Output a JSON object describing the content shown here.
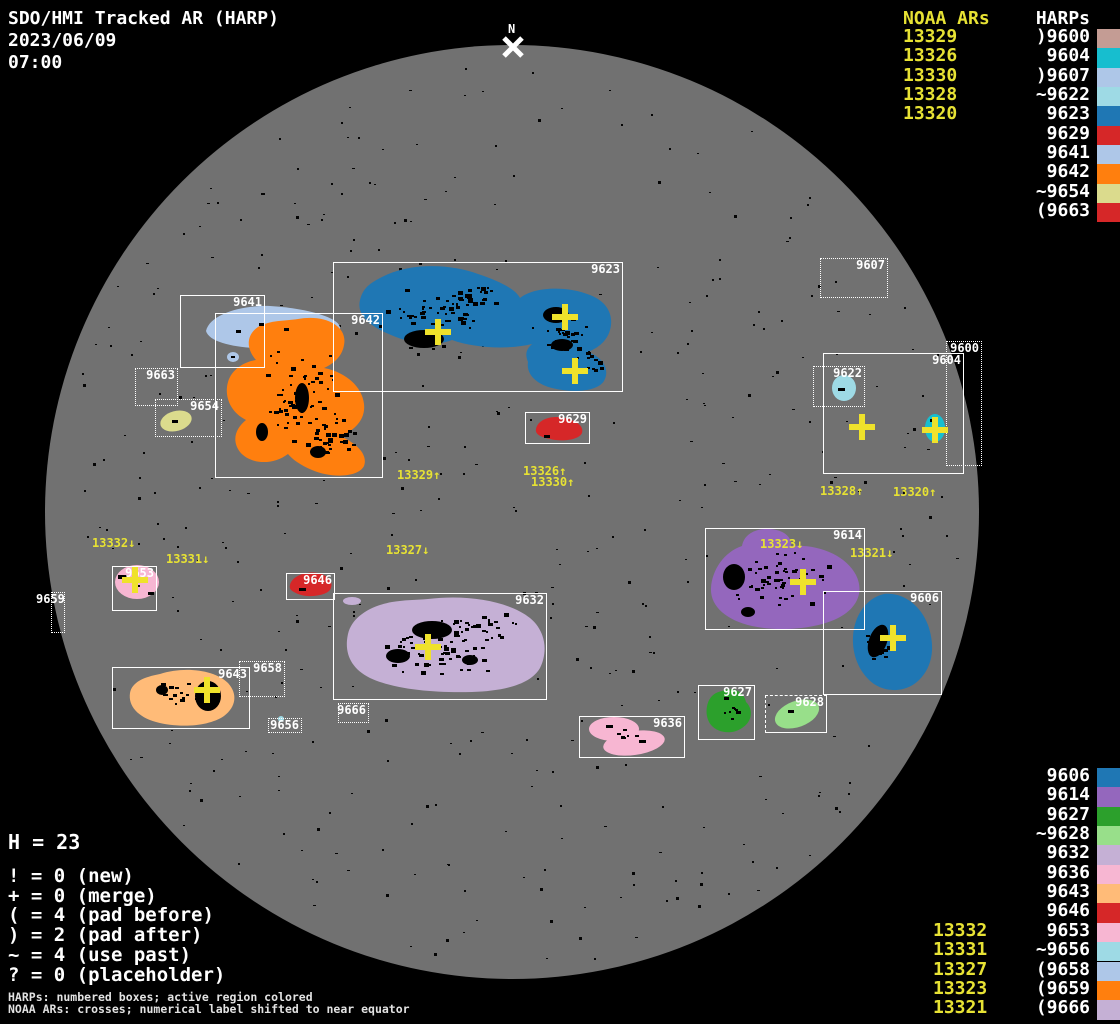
{
  "header": {
    "title": "SDO/HMI Tracked AR (HARP)",
    "date": "2023/06/09",
    "time": "07:00"
  },
  "panels": {
    "top_right": {
      "noaa_header": "NOAA ARs",
      "harps_header": "HARPs",
      "noaa": [
        "13329",
        "13326",
        "13330",
        "13328",
        "13320"
      ],
      "harps": [
        {
          "label": ")9600",
          "id": "9600"
        },
        {
          "label": "9604",
          "id": "9604"
        },
        {
          "label": ")9607",
          "id": "9607"
        },
        {
          "label": "~9622",
          "id": "9622"
        },
        {
          "label": "9623",
          "id": "9623"
        },
        {
          "label": "9629",
          "id": "9629"
        },
        {
          "label": "9641",
          "id": "9641"
        },
        {
          "label": "9642",
          "id": "9642"
        },
        {
          "label": "~9654",
          "id": "9654"
        },
        {
          "label": "(9663",
          "id": "9663"
        }
      ]
    },
    "bottom_right": {
      "harps": [
        {
          "label": "9606",
          "id": "9606"
        },
        {
          "label": "9614",
          "id": "9614"
        },
        {
          "label": "9627",
          "id": "9627"
        },
        {
          "label": "~9628",
          "id": "9628"
        },
        {
          "label": "9632",
          "id": "9632"
        },
        {
          "label": "9636",
          "id": "9636"
        },
        {
          "label": "9643",
          "id": "9643"
        },
        {
          "label": "9646",
          "id": "9646"
        },
        {
          "label": "9653",
          "id": "9653"
        },
        {
          "label": "~9656",
          "id": "9656"
        },
        {
          "label": "(9658",
          "id": "9658"
        },
        {
          "label": "(9659",
          "id": "9659"
        },
        {
          "label": "(9666",
          "id": "9666"
        }
      ],
      "noaa": [
        "13332",
        "13331",
        "13327",
        "13323",
        "13321"
      ],
      "noaa_start_row": 8
    }
  },
  "legend": {
    "h_line": "H = 23",
    "items": [
      "! = 0 (new)",
      "+ = 0 (merge)",
      "( = 4 (pad before)",
      ") = 2 (pad after)",
      "~ = 4 (use past)",
      "? = 0 (placeholder)"
    ]
  },
  "footer": {
    "line1": "HARPs: numbered boxes; active region colored",
    "line2": "NOAA ARs: crosses; numerical label shifted to near equator"
  },
  "palette": {
    "9600": "#c49c94",
    "9604": "#17becf",
    "9607": "#aec7e8",
    "9622": "#9edae5",
    "9623": "#1f77b4",
    "9629": "#d62728",
    "9641": "#aec7e8",
    "9642": "#ff7f0e",
    "9654": "#dbdb8d",
    "9663": "#d62728",
    "9606": "#1f77b4",
    "9614": "#9467bd",
    "9627": "#2ca02c",
    "9628": "#98df8a",
    "9632": "#c5b0d5",
    "9636": "#f7b6d2",
    "9643": "#ffbb78",
    "9646": "#d62728",
    "9653": "#f7b6d2",
    "9656": "#9edae5",
    "9658": "#aec7e8",
    "9659": "#ff7f0e",
    "9666": "#c5b0d5"
  },
  "disk": {
    "north_label": "N",
    "boxes": [
      {
        "id": "9641",
        "x": 180,
        "y": 295,
        "w": 85,
        "h": 73,
        "style": "solid"
      },
      {
        "id": "9663",
        "x": 135,
        "y": 368,
        "w": 43,
        "h": 38,
        "style": "dotted"
      },
      {
        "id": "9654",
        "x": 155,
        "y": 399,
        "w": 67,
        "h": 38,
        "style": "dotted"
      },
      {
        "id": "9642",
        "x": 215,
        "y": 313,
        "w": 168,
        "h": 165,
        "style": "solid"
      },
      {
        "id": "9623",
        "x": 333,
        "y": 262,
        "w": 290,
        "h": 130,
        "style": "solid"
      },
      {
        "id": "9629",
        "x": 525,
        "y": 412,
        "w": 65,
        "h": 32,
        "style": "solid"
      },
      {
        "id": "9607",
        "x": 820,
        "y": 258,
        "w": 68,
        "h": 40,
        "style": "dotted"
      },
      {
        "id": "9600",
        "x": 946,
        "y": 341,
        "w": 36,
        "h": 125,
        "style": "dotted"
      },
      {
        "id": "9604",
        "x": 823,
        "y": 353,
        "w": 141,
        "h": 121,
        "style": "solid"
      },
      {
        "id": "9622",
        "x": 813,
        "y": 366,
        "w": 52,
        "h": 41,
        "style": "dotted"
      },
      {
        "id": "9614",
        "x": 705,
        "y": 528,
        "w": 160,
        "h": 102,
        "style": "solid"
      },
      {
        "id": "9606",
        "x": 823,
        "y": 591,
        "w": 119,
        "h": 104,
        "style": "solid"
      },
      {
        "id": "9646",
        "x": 286,
        "y": 573,
        "w": 49,
        "h": 27,
        "style": "solid"
      },
      {
        "id": "9632",
        "x": 333,
        "y": 593,
        "w": 214,
        "h": 107,
        "style": "solid"
      },
      {
        "id": "9666",
        "x": 338,
        "y": 703,
        "w": 31,
        "h": 20,
        "style": "dotted"
      },
      {
        "id": "9653",
        "x": 112,
        "y": 566,
        "w": 45,
        "h": 45,
        "style": "solid"
      },
      {
        "id": "9659",
        "x": 51,
        "y": 592,
        "w": 14,
        "h": 41,
        "style": "dotted",
        "label_x": 36,
        "label_y": 593
      },
      {
        "id": "9643",
        "x": 112,
        "y": 667,
        "w": 138,
        "h": 62,
        "style": "solid"
      },
      {
        "id": "9658",
        "x": 239,
        "y": 661,
        "w": 46,
        "h": 36,
        "style": "dotted"
      },
      {
        "id": "9656",
        "x": 268,
        "y": 718,
        "w": 34,
        "h": 15,
        "style": "dotted"
      },
      {
        "id": "9636",
        "x": 579,
        "y": 716,
        "w": 106,
        "h": 42,
        "style": "solid"
      },
      {
        "id": "9627",
        "x": 698,
        "y": 685,
        "w": 57,
        "h": 55,
        "style": "solid"
      },
      {
        "id": "9628",
        "x": 765,
        "y": 695,
        "w": 62,
        "h": 38,
        "style": "mixed"
      }
    ],
    "crosses": [
      {
        "x": 438,
        "y": 332
      },
      {
        "x": 565,
        "y": 317
      },
      {
        "x": 575,
        "y": 371
      },
      {
        "x": 862,
        "y": 427
      },
      {
        "x": 935,
        "y": 430
      },
      {
        "x": 135,
        "y": 580
      },
      {
        "x": 207,
        "y": 690
      },
      {
        "x": 428,
        "y": 647
      },
      {
        "x": 803,
        "y": 582
      },
      {
        "x": 893,
        "y": 638
      }
    ],
    "noaa_labels": [
      {
        "text": "13329↑",
        "x": 397,
        "y": 469
      },
      {
        "text": "13326↑",
        "x": 523,
        "y": 465
      },
      {
        "text": "13330↑",
        "x": 531,
        "y": 476
      },
      {
        "text": "13328↑",
        "x": 820,
        "y": 485
      },
      {
        "text": "13320↑",
        "x": 893,
        "y": 486
      },
      {
        "text": "13332↓",
        "x": 92,
        "y": 537
      },
      {
        "text": "13331↓",
        "x": 166,
        "y": 553
      },
      {
        "text": "13327↓",
        "x": 386,
        "y": 544
      },
      {
        "text": "13323↓",
        "x": 760,
        "y": 538
      },
      {
        "text": "13321↓",
        "x": 850,
        "y": 547
      }
    ]
  }
}
